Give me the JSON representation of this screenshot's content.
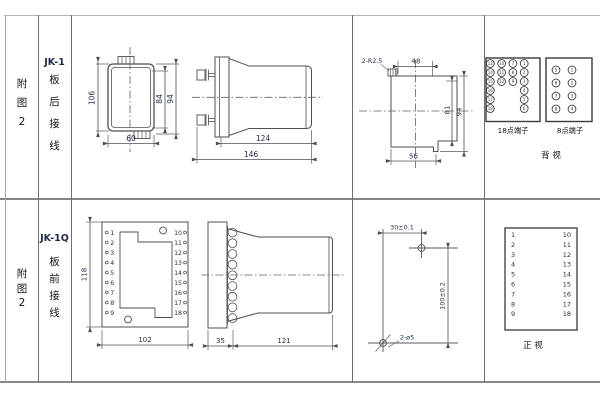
{
  "meta": {
    "background": "#ffffff",
    "drawing_line_color": "#4f4f4f",
    "grid_line_color": "#8a8a8a",
    "dimension_text_color": "#1e2a48",
    "label_text_color": "#141414"
  },
  "row1": {
    "figure_no": [
      "附",
      "图",
      "2"
    ],
    "model": "JK-1",
    "wiring": [
      "板",
      "后",
      "接",
      "线"
    ],
    "front_dims": {
      "height": "106",
      "inner_height": "84",
      "outer_height": "94",
      "width": "60"
    },
    "side_dims": {
      "case_depth": "124",
      "total_depth": "146"
    },
    "cutout_dims": {
      "corner_radius": "2-R2.5",
      "top_width": "48",
      "inner_height": "81",
      "outer_height": "94",
      "bottom_width": "56"
    },
    "t18": {
      "label": "18点端子",
      "r1": [
        "13",
        "10",
        "7",
        "1"
      ],
      "r2": [
        "14",
        "11",
        "8",
        "2"
      ],
      "r3": [
        "15",
        "12",
        "9",
        "3"
      ],
      "left_col": [
        "16",
        "17",
        "18"
      ],
      "right_col": [
        "4",
        "5",
        "6"
      ]
    },
    "t8": {
      "label": "8点端子",
      "left": [
        "5",
        "6",
        "7",
        "8"
      ],
      "right": [
        "1",
        "2",
        "3",
        "4"
      ]
    },
    "view_label": "背  视"
  },
  "row2": {
    "figure_no": [
      "附",
      "图",
      "2"
    ],
    "model": "JK-1Q",
    "wiring": [
      "板",
      "前",
      "接",
      "线"
    ],
    "front": {
      "height": "118",
      "width": "102",
      "left": [
        "1",
        "2",
        "3",
        "4",
        "5",
        "6",
        "7",
        "8",
        "9"
      ],
      "right": [
        "10",
        "11",
        "12",
        "13",
        "14",
        "15",
        "16",
        "17",
        "18"
      ]
    },
    "side_dims": {
      "front_depth": "35",
      "case_depth": "121"
    },
    "drill_dims": {
      "h_spacing": "30±0.1",
      "v_spacing": "100±0.2",
      "holes": "2-ø5"
    },
    "table": {
      "left": [
        "1",
        "2",
        "3",
        "4",
        "5",
        "6",
        "7",
        "8",
        "9"
      ],
      "right": [
        "10",
        "11",
        "12",
        "13",
        "14",
        "15",
        "16",
        "17",
        "18"
      ],
      "view_label": "正  视"
    }
  }
}
